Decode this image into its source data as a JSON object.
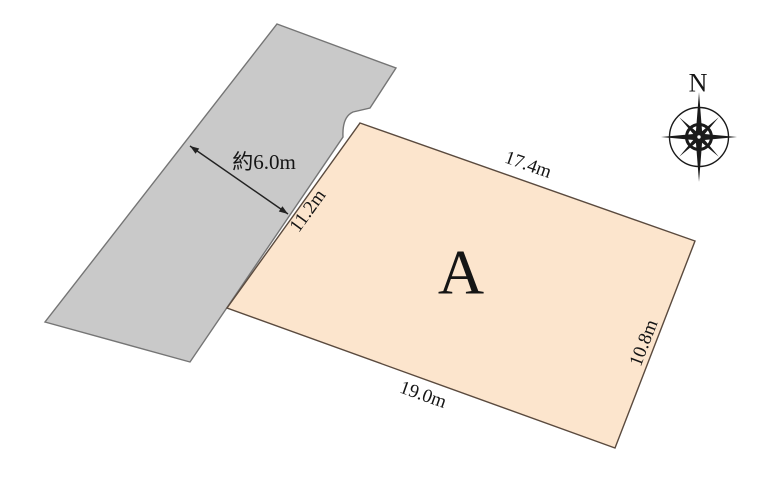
{
  "compass": {
    "north_label": "N"
  },
  "road": {
    "width_label": "約6.0m",
    "fill": "#c9c9c9"
  },
  "plot": {
    "label": "A",
    "fill": "#fce5cd",
    "dimensions": {
      "top": "17.4m",
      "right": "10.8m",
      "bottom": "19.0m",
      "left": "11.2m"
    }
  }
}
